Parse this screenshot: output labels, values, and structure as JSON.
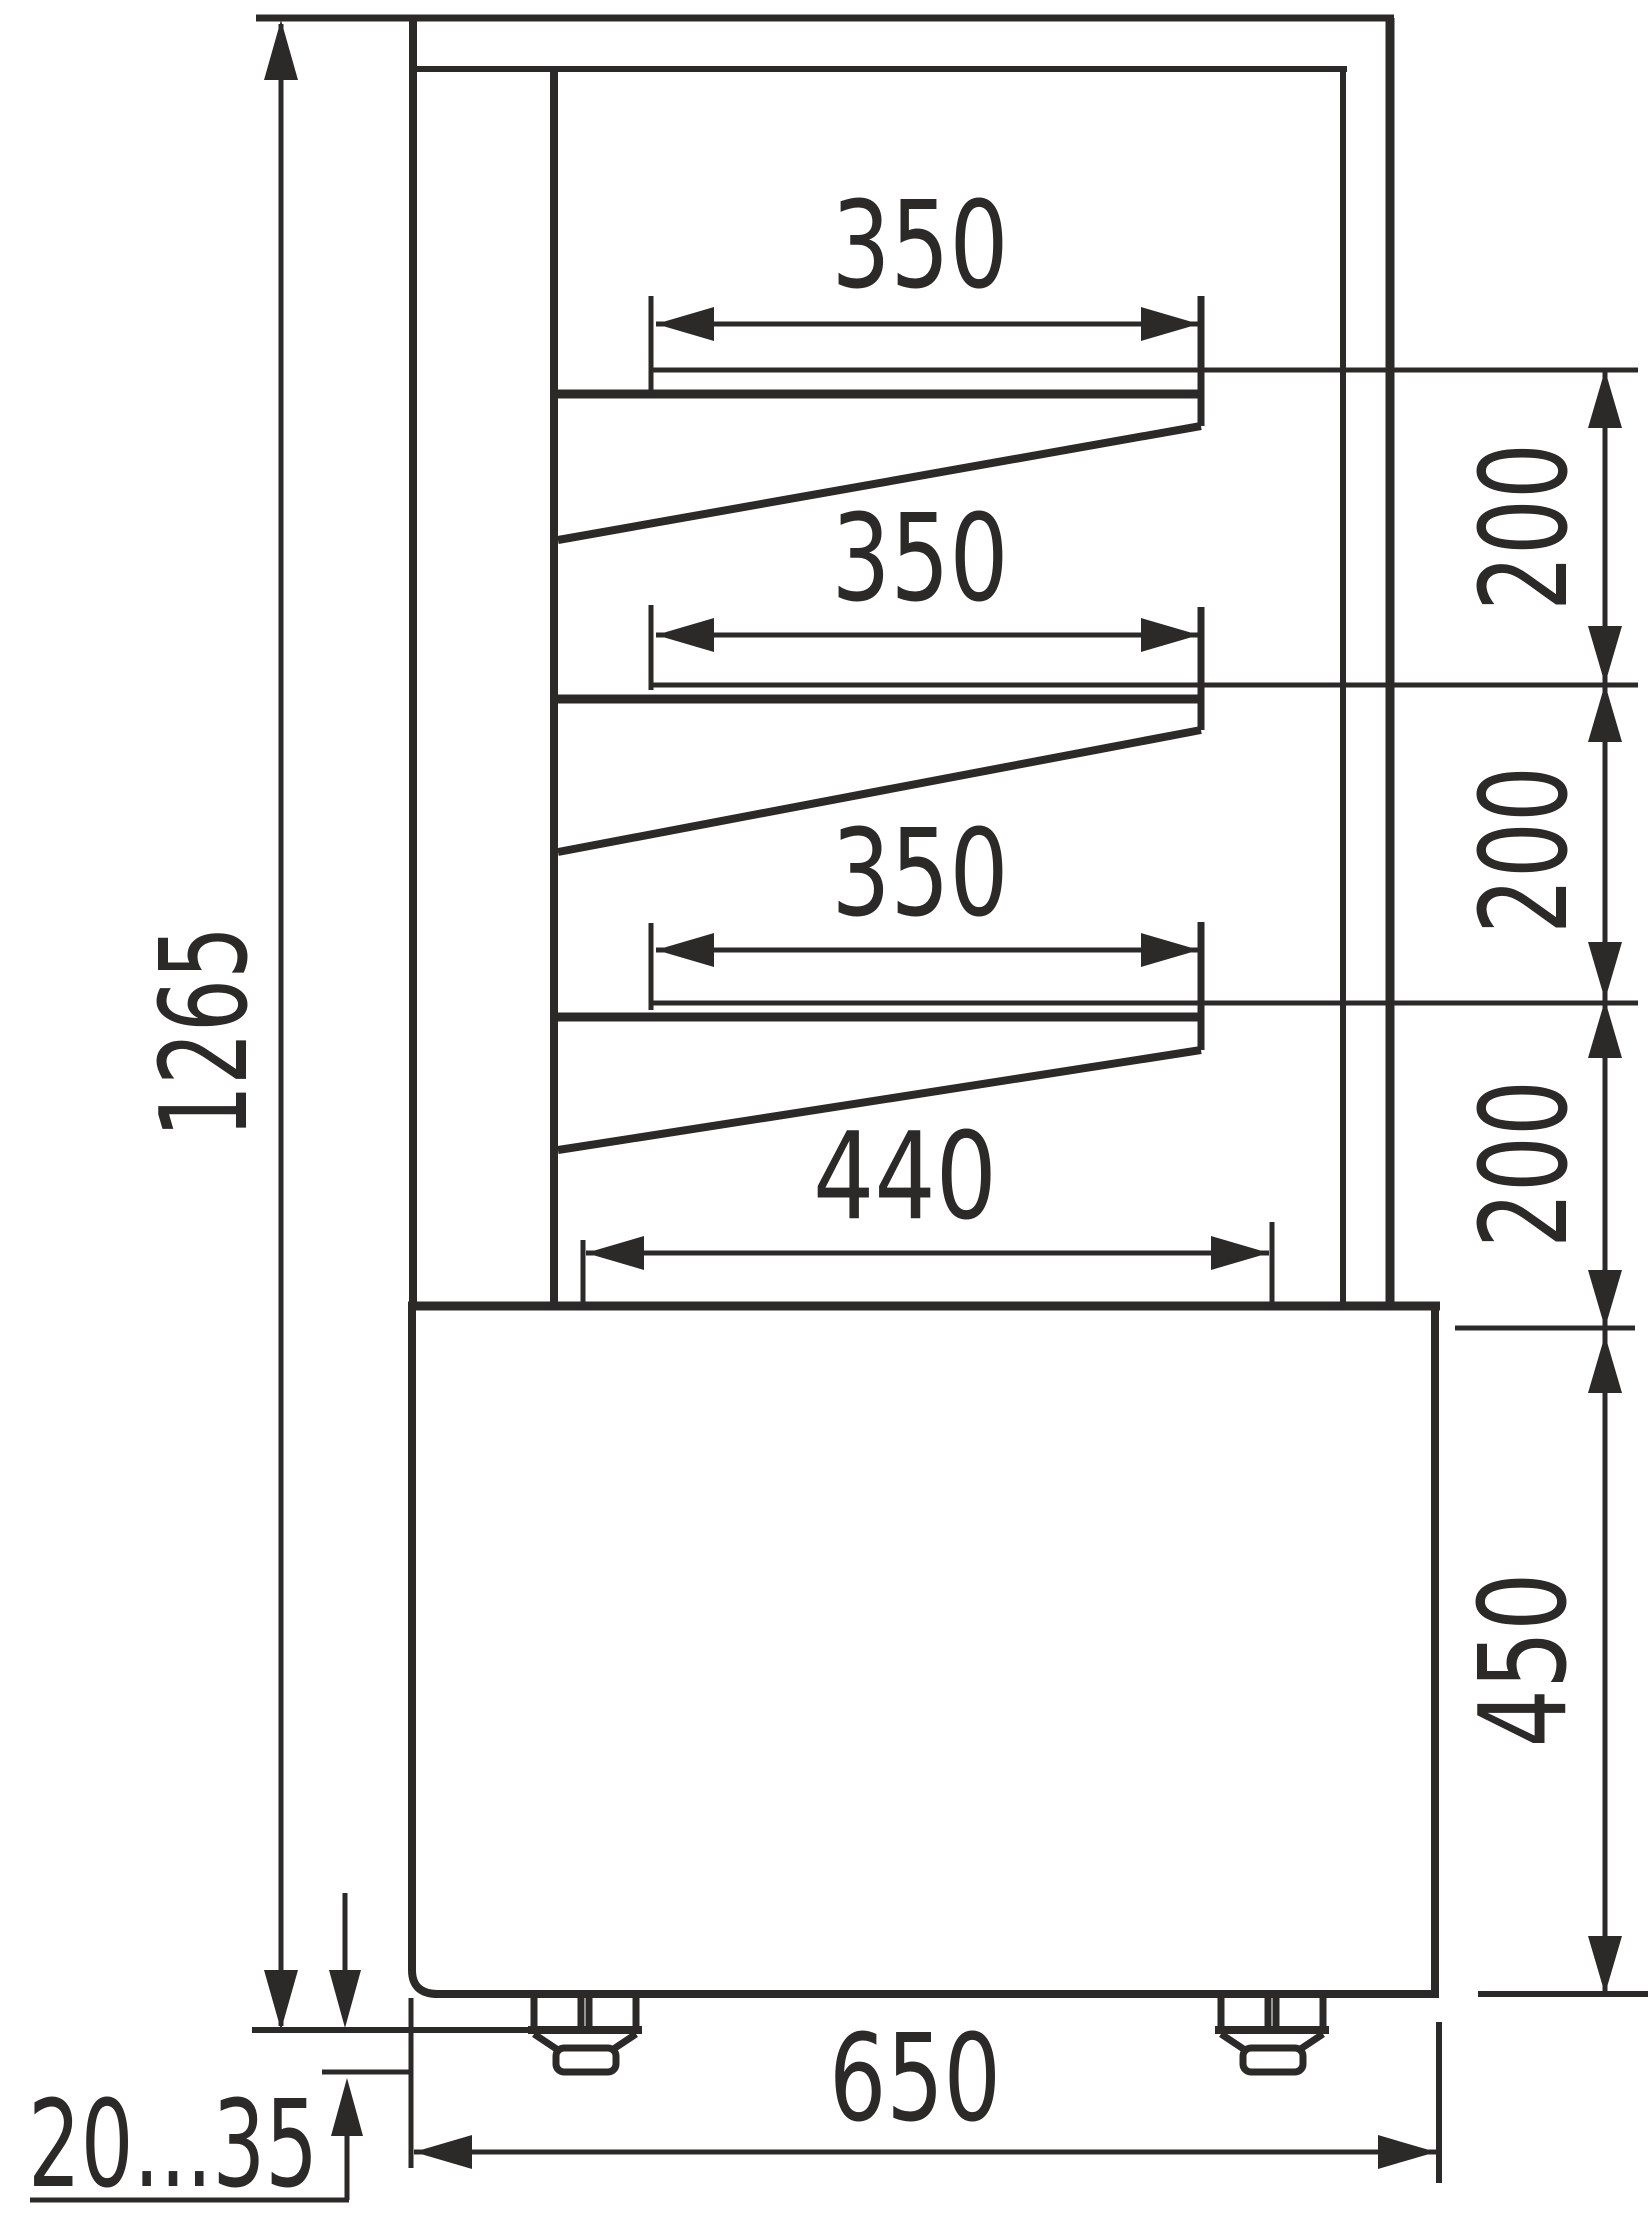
{
  "drawing": {
    "type": "technical-dimension-drawing",
    "subject": "refrigerated display case side-section view with three slanted shelves, base cabinet and adjustable feet",
    "line_color": "#2b2a29",
    "background_color": "#ffffff",
    "labels": {
      "total_height": "1265",
      "shelf1_width": "350",
      "shelf2_width": "350",
      "shelf3_width": "350",
      "base_shelf_width": "440",
      "shelf_gap_1": "200",
      "shelf_gap_2": "200",
      "shelf_gap_3": "200",
      "base_height": "450",
      "base_depth": "650",
      "foot_adjust_range": "20...35"
    }
  }
}
